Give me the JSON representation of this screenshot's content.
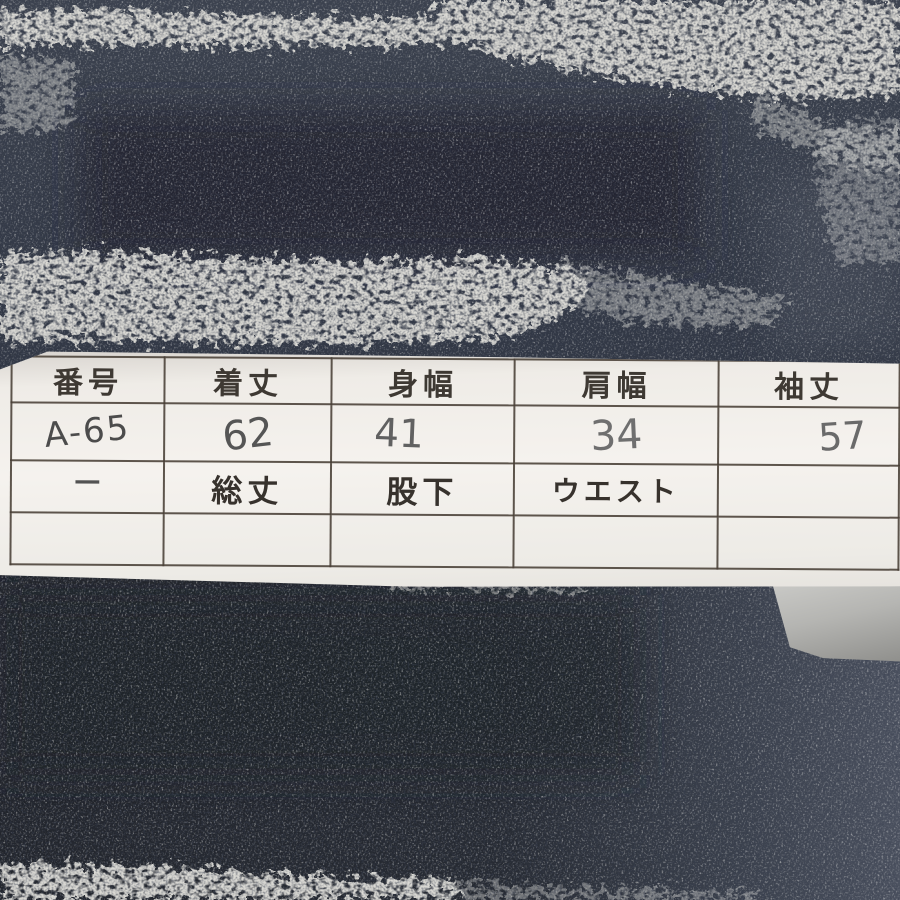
{
  "scene": {
    "subject": "knit-fabric-with-size-tag-photo",
    "colors": {
      "fabric_navy_dark": "#23262e",
      "fabric_slate": "#3a404c",
      "fabric_slate_light": "#4c5260",
      "heather_gray": "#d8d7d2",
      "paper_white": "#f2efeb",
      "under_paper_gray": "#b0b0ad",
      "table_line": "#4f4841",
      "printed_text": "#3e3933",
      "handwriting_gray": "#5e5e5e"
    }
  },
  "size_table": {
    "headers": [
      "番号",
      "着丈",
      "身幅",
      "肩幅",
      "袖丈"
    ],
    "measurements": [
      "A-65",
      "62",
      "41",
      "34",
      "57"
    ],
    "sub_headers": [
      "−",
      "総丈",
      "股下",
      "ウエスト",
      ""
    ]
  }
}
